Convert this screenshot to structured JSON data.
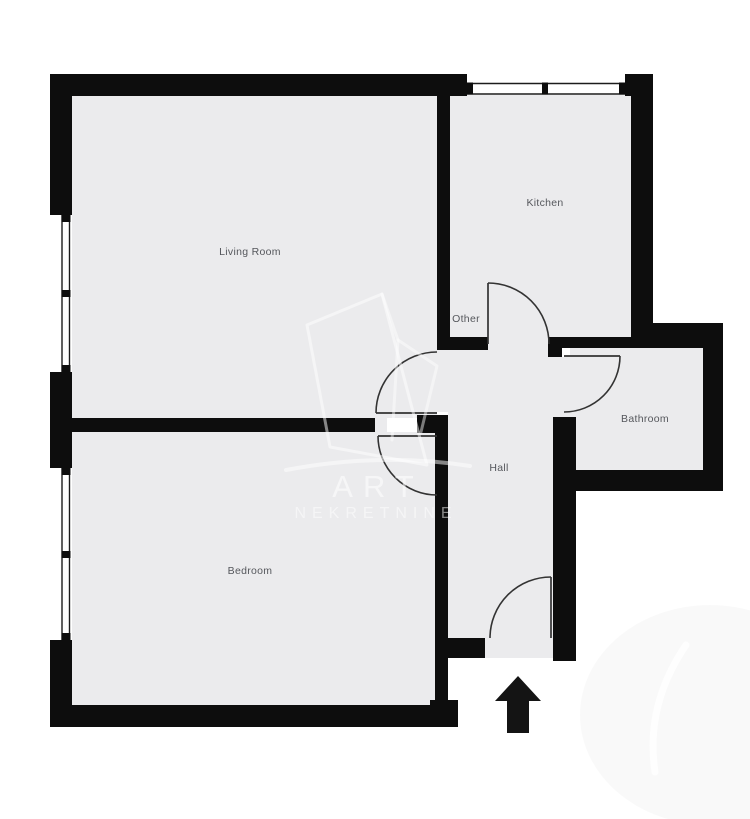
{
  "canvas": {
    "width": 750,
    "height": 819
  },
  "colors": {
    "background": "#ffffff",
    "floor": "#ebebed",
    "wall": "#0d0d0d",
    "door_line": "#333333",
    "window_line": "#1c1c1c",
    "label_text": "#55575c",
    "arrow": "#141414",
    "watermark_white": "#ffffff"
  },
  "rooms": [
    {
      "name": "living-room",
      "label": "Living Room",
      "x": 250,
      "y": 252
    },
    {
      "name": "kitchen",
      "label": "Kitchen",
      "x": 545,
      "y": 203
    },
    {
      "name": "other",
      "label": "Other",
      "x": 466,
      "y": 319
    },
    {
      "name": "bathroom",
      "label": "Bathroom",
      "x": 645,
      "y": 419
    },
    {
      "name": "hall",
      "label": "Hall",
      "x": 499,
      "y": 468
    },
    {
      "name": "bedroom",
      "label": "Bedroom",
      "x": 250,
      "y": 571
    }
  ],
  "floors": [
    {
      "name": "floor-living-room",
      "rect": [
        72,
        96,
        365,
        322
      ]
    },
    {
      "name": "floor-kitchen",
      "rect": [
        450,
        95,
        183,
        242
      ]
    },
    {
      "name": "floor-hall",
      "rect": [
        448,
        337,
        106,
        301
      ]
    },
    {
      "name": "floor-entry-recess",
      "rect": [
        485,
        638,
        68,
        20
      ]
    },
    {
      "name": "floor-bathroom",
      "rect": [
        570,
        348,
        133,
        122
      ]
    },
    {
      "name": "floor-bathroom-doorway",
      "rect": [
        554,
        357,
        16,
        60
      ]
    },
    {
      "name": "floor-bedroom",
      "rect": [
        72,
        432,
        363,
        273
      ]
    },
    {
      "name": "floor-livingroom-doorway",
      "rect": [
        437,
        350,
        11,
        62
      ]
    },
    {
      "name": "floor-bedroom-doorway",
      "rect": [
        435,
        433,
        13,
        64
      ]
    },
    {
      "name": "floor-wall-gap",
      "rect": [
        375,
        415,
        12,
        18
      ]
    }
  ],
  "walls": [
    {
      "name": "wall-top",
      "rect": [
        50,
        74,
        417,
        22
      ]
    },
    {
      "name": "wall-top-right-block",
      "rect": [
        625,
        74,
        28,
        22
      ]
    },
    {
      "name": "wall-left-upper",
      "rect": [
        50,
        74,
        22,
        141
      ]
    },
    {
      "name": "wall-left-middle",
      "rect": [
        50,
        372,
        22,
        96
      ]
    },
    {
      "name": "wall-left-lower",
      "rect": [
        50,
        640,
        22,
        87
      ]
    },
    {
      "name": "wall-bottom",
      "rect": [
        50,
        705,
        408,
        22
      ]
    },
    {
      "name": "wall-bedroom-corner",
      "rect": [
        430,
        700,
        28,
        27
      ]
    },
    {
      "name": "wall-living-kitchen-divider",
      "rect": [
        437,
        92,
        13,
        253
      ]
    },
    {
      "name": "wall-other-bottom",
      "rect": [
        437,
        337,
        51,
        13
      ]
    },
    {
      "name": "wall-kitchen-right",
      "rect": [
        631,
        96,
        22,
        241
      ]
    },
    {
      "name": "wall-bath-top-exterior",
      "rect": [
        653,
        323,
        70,
        25
      ]
    },
    {
      "name": "wall-kitchen-bathroom",
      "rect": [
        560,
        337,
        93,
        11
      ]
    },
    {
      "name": "wall-bathroom-door-pier",
      "rect": [
        548,
        337,
        14,
        20
      ]
    },
    {
      "name": "wall-right",
      "rect": [
        703,
        348,
        20,
        142
      ]
    },
    {
      "name": "wall-bathroom-bottom",
      "rect": [
        562,
        470,
        161,
        21
      ]
    },
    {
      "name": "wall-hall-right",
      "rect": [
        553,
        417,
        23,
        244
      ]
    },
    {
      "name": "wall-hall-left",
      "rect": [
        435,
        433,
        13,
        267
      ]
    },
    {
      "name": "wall-door-pier",
      "rect": [
        417,
        415,
        31,
        18
      ]
    },
    {
      "name": "wall-living-bedroom",
      "rect": [
        72,
        418,
        303,
        14
      ]
    },
    {
      "name": "wall-hall-step-left",
      "rect": [
        448,
        638,
        37,
        20
      ]
    }
  ],
  "windows": [
    {
      "name": "living-room-window",
      "orient": "v",
      "lines": [
        62,
        69.5
      ],
      "from": 215,
      "to": 372,
      "ticks": [
        215,
        290,
        365
      ],
      "tick_base": 61.5,
      "tick_w": 9,
      "tick_h": 7
    },
    {
      "name": "bedroom-window",
      "orient": "v",
      "lines": [
        62,
        69.5
      ],
      "from": 468,
      "to": 640,
      "ticks": [
        468,
        551,
        633
      ],
      "tick_base": 61.5,
      "tick_w": 9,
      "tick_h": 7
    },
    {
      "name": "kitchen-window",
      "orient": "h",
      "lines": [
        83.5,
        94
      ],
      "from": 467,
      "to": 625,
      "ticks": [
        467,
        542,
        619
      ],
      "tick_base": 82.5,
      "tick_w": 6,
      "tick_h": 12
    }
  ],
  "doors": [
    {
      "name": "kitchen-door",
      "leaf": "M 488 344 L 488 283",
      "arc": "M 488 283 A 61 61 0 0 1 549 344"
    },
    {
      "name": "living-room-door",
      "leaf": "M 437 413 L 376 413",
      "arc": "M 437 352 A 61 61 0 0 0 376 413"
    },
    {
      "name": "bedroom-door",
      "leaf": "M 437 436 L 378 436",
      "arc": "M 378 436 A 59 59 0 0 0 437 495"
    },
    {
      "name": "bathroom-door",
      "leaf": "M 564 356 L 620 356",
      "arc": "M 620 356 A 56 56 0 0 1 564 412"
    },
    {
      "name": "entrance-door",
      "leaf": "M 551 577 L 551 638",
      "arc": "M 551 577 A 61 61 0 0 0 490 638"
    }
  ],
  "entrance_arrow": {
    "points": "518,676 541,701 529,701 529,733 507,733 507,701 495,701"
  },
  "watermark": {
    "line1": "ART",
    "line2": "NEKRETNINE",
    "texts": [
      {
        "key": "line1",
        "x": 378,
        "y": 497,
        "size": 31,
        "spacing": 10,
        "opacity": 0.55
      },
      {
        "key": "line2",
        "x": 376,
        "y": 518,
        "size": 16,
        "spacing": 6,
        "opacity": 0.5
      }
    ],
    "paths": [
      {
        "d": "M 307 325 L 382 294 L 427 465 L 330 447 Z",
        "w": 3,
        "o": 0.5
      },
      {
        "d": "M 382 294 L 398 340 L 392 440",
        "w": 3,
        "o": 0.45
      },
      {
        "d": "M 398 340 L 437 366 L 421 432",
        "w": 3,
        "o": 0.45
      },
      {
        "d": "M 286 470 Q 380 452 470 466",
        "w": 4,
        "o": 0.5
      },
      {
        "d": "M 686 645 Q 645 705 655 772",
        "w": 7,
        "o": 0.8
      },
      {
        "d": "M 40 752 Q 380 818 720 700",
        "w": 26,
        "o": 0.0
      }
    ],
    "shade": {
      "cx": 710,
      "cy": 715,
      "rx": 130,
      "ry": 110,
      "opacity": 0.025
    }
  }
}
